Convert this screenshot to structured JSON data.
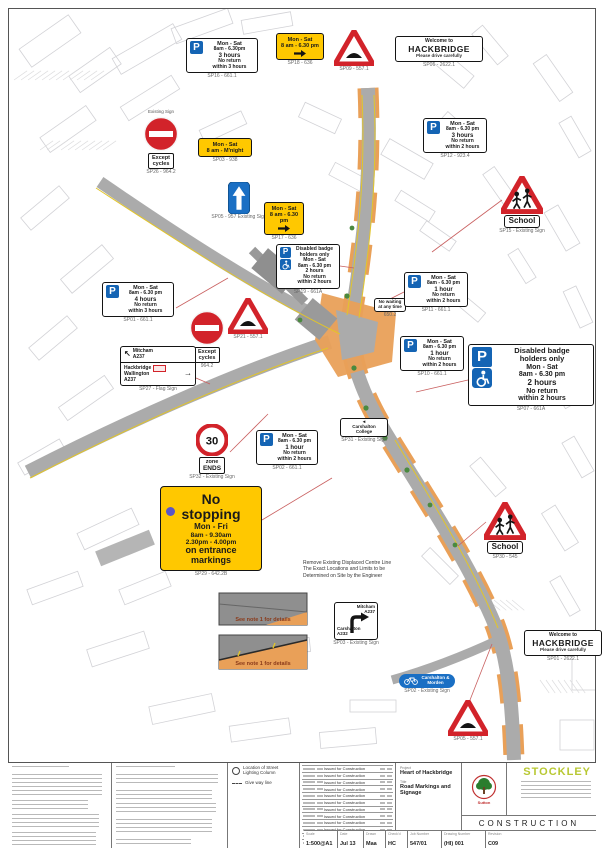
{
  "signs": [
    {
      "id": "welcome-top",
      "type": "welcome",
      "lines": [
        "Welcome to",
        "HACKBRIDGE",
        "Please drive carefully"
      ],
      "caption": "SP06 - 2622.1"
    },
    {
      "id": "hump-top",
      "type": "hump",
      "caption": "SP09 - 557.1"
    },
    {
      "id": "p-top-left",
      "type": "parking",
      "lines": [
        "Mon - Sat",
        "8am - 6.30pm",
        "3 hours",
        "No return",
        "within 3 hours"
      ],
      "caption": "SP16 - 661.1"
    },
    {
      "id": "yellow-top",
      "type": "yellow",
      "lines": [
        "Mon - Sat",
        "8 am - 6.30 pm"
      ],
      "arrow": "right",
      "caption": "SP18 - 636"
    },
    {
      "id": "p-right-top",
      "type": "parking",
      "lines": [
        "Mon - Sat",
        "8am - 6.30 pm",
        "3 hours",
        "No return",
        "within 2 hours"
      ],
      "caption": "SP12 - 923.4"
    },
    {
      "id": "school-right",
      "type": "school",
      "plate": "School",
      "caption": "SP15 - Existing Sign"
    },
    {
      "id": "noentry-top",
      "type": "noentry",
      "top_label": "Existing Sign",
      "plate": [
        "Except",
        "cycles"
      ],
      "caption": "SP26 - 964.2"
    },
    {
      "id": "yellow-mnight",
      "type": "yellow",
      "lines": [
        "Mon - Sat",
        "8 am - M'night"
      ],
      "arrow": "none",
      "caption": "SP03 - 938"
    },
    {
      "id": "arrow-up",
      "type": "bluearrow",
      "caption": "SP05 - 957 Existing Sign"
    },
    {
      "id": "yellow-mid",
      "type": "yellow",
      "lines": [
        "Mon - Sat",
        "8 am - 6.30 pm"
      ],
      "arrow": "right",
      "caption": "SP17 - 636"
    },
    {
      "id": "disabled-mid",
      "type": "disabled-small",
      "lines": [
        "Disabled badge",
        "holders only",
        "Mon - Sat",
        "8am - 6.30 pm",
        "2 hours",
        "No return",
        "within 2 hours"
      ],
      "caption": "SP19 - 661A"
    },
    {
      "id": "p-left",
      "type": "parking",
      "lines": [
        "Mon - Sat",
        "8am - 6.30 pm",
        "4 hours",
        "No return",
        "within 3 hours"
      ],
      "caption": "SP01 - 661.1"
    },
    {
      "id": "noentry-mid",
      "type": "noentry",
      "top_label": "",
      "plate": [
        "Except",
        "cycles"
      ],
      "caption": "964.2"
    },
    {
      "id": "hump-mid",
      "type": "hump",
      "caption": "SP21 - 557.1"
    },
    {
      "id": "direction-left",
      "type": "direction",
      "p1": [
        "Mitcham",
        "A237"
      ],
      "p2": [
        "Hackbridge",
        "Wallington",
        "A237"
      ],
      "caption": "SP27 - Flag Sign"
    },
    {
      "id": "no-waiting",
      "type": "smallbox",
      "lines": [
        "No waiting",
        "at any time"
      ],
      "caption": "650.2"
    },
    {
      "id": "p-right-1",
      "type": "parking",
      "lines": [
        "Mon - Sat",
        "8am - 6.30 pm",
        "1 hour",
        "No return",
        "within 2 hours"
      ],
      "caption": "SP11 - 661.1"
    },
    {
      "id": "p-right-2",
      "type": "parking",
      "lines": [
        "Mon - Sat",
        "8am - 6.30 pm",
        "1 hour",
        "No return",
        "within 2 hours"
      ],
      "caption": "SP10 - 661.1"
    },
    {
      "id": "disabled-big",
      "type": "disabled-big",
      "lines": [
        "Disabled badge",
        "holders only",
        "Mon - Sat",
        "8am - 6.30 pm",
        "2 hours",
        "No return",
        "within 2 hours"
      ],
      "caption": "SP07 - 661A"
    },
    {
      "id": "zone-30",
      "type": "speed30",
      "value": "30",
      "plate": [
        "zone",
        "ENDS"
      ],
      "caption": "SP32 - Existing Sign"
    },
    {
      "id": "college",
      "type": "smallbox",
      "arrow": "left",
      "lines": [
        "Carshalton",
        "College"
      ],
      "caption": "SP31 - Existing Sign"
    },
    {
      "id": "p-mid",
      "type": "parking",
      "lines": [
        "Mon - Sat",
        "8am - 6.30 pm",
        "1 hour",
        "No return",
        "within 2 hours"
      ],
      "caption": "SP02 - 661.1"
    },
    {
      "id": "no-stopping",
      "type": "nostopping",
      "lines": [
        "No",
        "stopping",
        "Mon - Fri",
        "8am - 9.30am",
        "2.30pm - 4.00pm",
        "on entrance",
        "markings"
      ],
      "caption": "SP29 - 642.2B"
    },
    {
      "id": "school-bottom",
      "type": "school",
      "plate": "School",
      "caption": "SP30 - 545"
    },
    {
      "id": "removal-note",
      "type": "note",
      "lines": [
        "Remove Existing Displaced Centre Line",
        "The Exact Locations and Limits to be",
        "Determined on Site by the Engineer"
      ],
      "caption": ""
    },
    {
      "id": "detail-grey",
      "type": "detailbox",
      "variant": "grey",
      "label": "See note 1 for details",
      "caption": ""
    },
    {
      "id": "detail-orange",
      "type": "detailbox",
      "variant": "orange",
      "label": "See note 1 for details",
      "caption": ""
    },
    {
      "id": "junction-sign",
      "type": "junction",
      "top": [
        "Mitcham",
        "A237"
      ],
      "side": [
        "Carshalton",
        "A232"
      ],
      "caption": "SP03 - Existing Sign"
    },
    {
      "id": "cycle-sign",
      "type": "cycle",
      "lines": [
        "Carshalton &",
        "Morden"
      ],
      "caption": "SP02 - Existing Sign"
    },
    {
      "id": "welcome-bottom",
      "type": "welcome",
      "lines": [
        "Welcome to",
        "HACKBRIDGE",
        "Please drive carefully"
      ],
      "caption": "SP01 - 2622.1"
    },
    {
      "id": "hump-bottom",
      "type": "hump",
      "caption": "SP05 - 557.1"
    }
  ],
  "titleblock": {
    "legend": [
      {
        "symbol": "circle",
        "label": "Location of Street Lighting Column"
      },
      {
        "symbol": "dash",
        "label": "Give way line"
      }
    ],
    "revisions": [
      "Issued for Construction",
      "Issued for Construction",
      "Issued for Construction",
      "Issued for Construction",
      "Issued for Construction",
      "Issued for Construction",
      "Issued for Construction",
      "Issued for Construction",
      "Issued for Construction",
      "Issued for Construction",
      "Issued for Tender",
      "Issued for Information"
    ],
    "project_label": "Project",
    "project": "Heart of Hackbridge",
    "title_label": "Title",
    "title": "Road Markings and Signage",
    "fields": [
      {
        "label": "Scale",
        "value": "1:500@A1"
      },
      {
        "label": "Date",
        "value": "Jul 13"
      },
      {
        "label": "Drawn",
        "value": "Maa"
      },
      {
        "label": "Check'd",
        "value": "HC"
      },
      {
        "label": "Job Number",
        "value": "547/01"
      },
      {
        "label": "Drawing Number",
        "value": "(HI) 001"
      },
      {
        "label": "Revision",
        "value": "C09"
      }
    ],
    "status": "CONSTRUCTION",
    "brand": "STOCKLEY",
    "logo_text": "Sutton"
  },
  "colors": {
    "sign_yellow": "#ffc800",
    "sign_blue": "#1464b4",
    "sign_red": "#d2232a",
    "road_grey": "#ababab",
    "paving_orange": "#e9a058",
    "brand_green": "#b8c832",
    "tree_green": "#2a7d2e"
  }
}
